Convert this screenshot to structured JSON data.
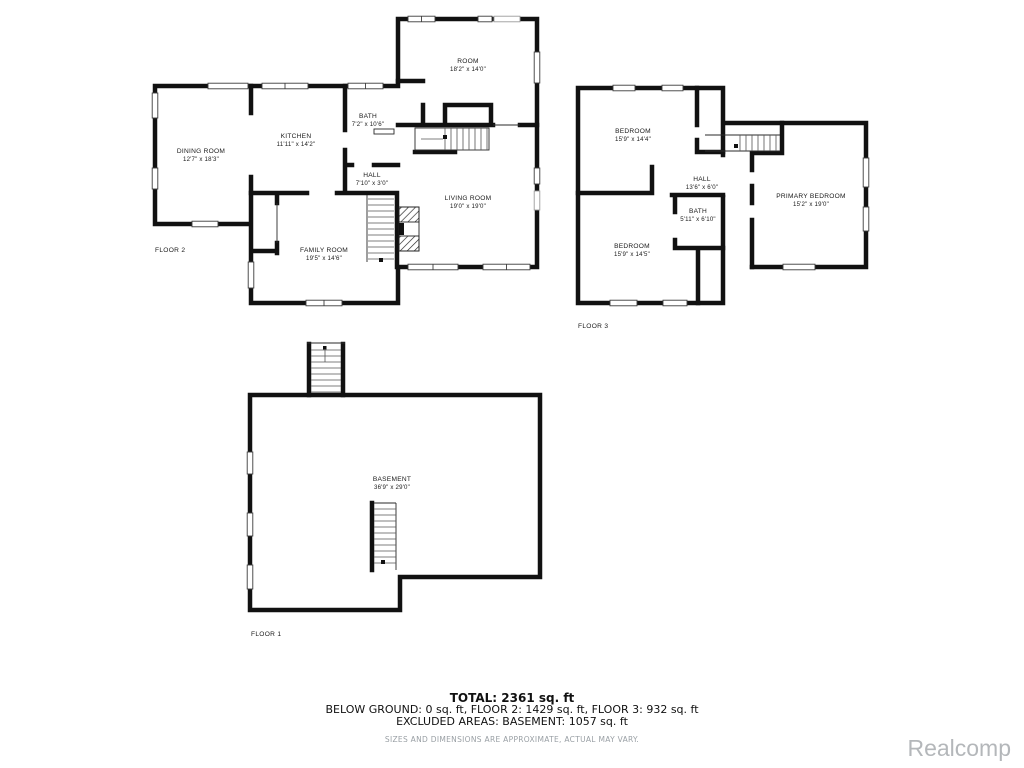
{
  "floors": {
    "floor2": {
      "label": "FLOOR 2",
      "rooms": [
        {
          "name": "ROOM",
          "dims": "18'2\" x 14'0\""
        },
        {
          "name": "BATH",
          "dims": "7'2\" x 10'6\""
        },
        {
          "name": "KITCHEN",
          "dims": "11'11\" x 14'2\""
        },
        {
          "name": "DINING ROOM",
          "dims": "12'7\" x 18'3\""
        },
        {
          "name": "HALL",
          "dims": "7'10\" x 3'0\""
        },
        {
          "name": "LIVING ROOM",
          "dims": "19'0\" x 19'0\""
        },
        {
          "name": "FAMILY ROOM",
          "dims": "19'5\" x 14'6\""
        }
      ]
    },
    "floor3": {
      "label": "FLOOR 3",
      "rooms": [
        {
          "name": "BEDROOM",
          "dims": "15'9\" x 14'4\""
        },
        {
          "name": "HALL",
          "dims": "13'6\" x 6'0\""
        },
        {
          "name": "PRIMARY BEDROOM",
          "dims": "15'2\" x 19'0\""
        },
        {
          "name": "BATH",
          "dims": "5'11\" x 6'10\""
        },
        {
          "name": "BEDROOM",
          "dims": "15'9\" x 14'5\""
        }
      ]
    },
    "floor1": {
      "label": "FLOOR 1",
      "rooms": [
        {
          "name": "BASEMENT",
          "dims": "36'9\" x 29'0\""
        }
      ]
    }
  },
  "summary": {
    "total": "TOTAL: 2361 sq. ft",
    "line2": "BELOW GROUND: 0 sq. ft, FLOOR 2: 1429 sq. ft, FLOOR 3: 932 sq. ft",
    "line3": "EXCLUDED AREAS: BASEMENT: 1057 sq. ft",
    "disclaimer": "SIZES AND DIMENSIONS ARE APPROXIMATE, ACTUAL MAY VARY."
  },
  "watermark": "Realcomp",
  "colors": {
    "wall": "#111111",
    "watermark": "#b4b7ba",
    "disclaimer_text": "#9aa0a5"
  }
}
